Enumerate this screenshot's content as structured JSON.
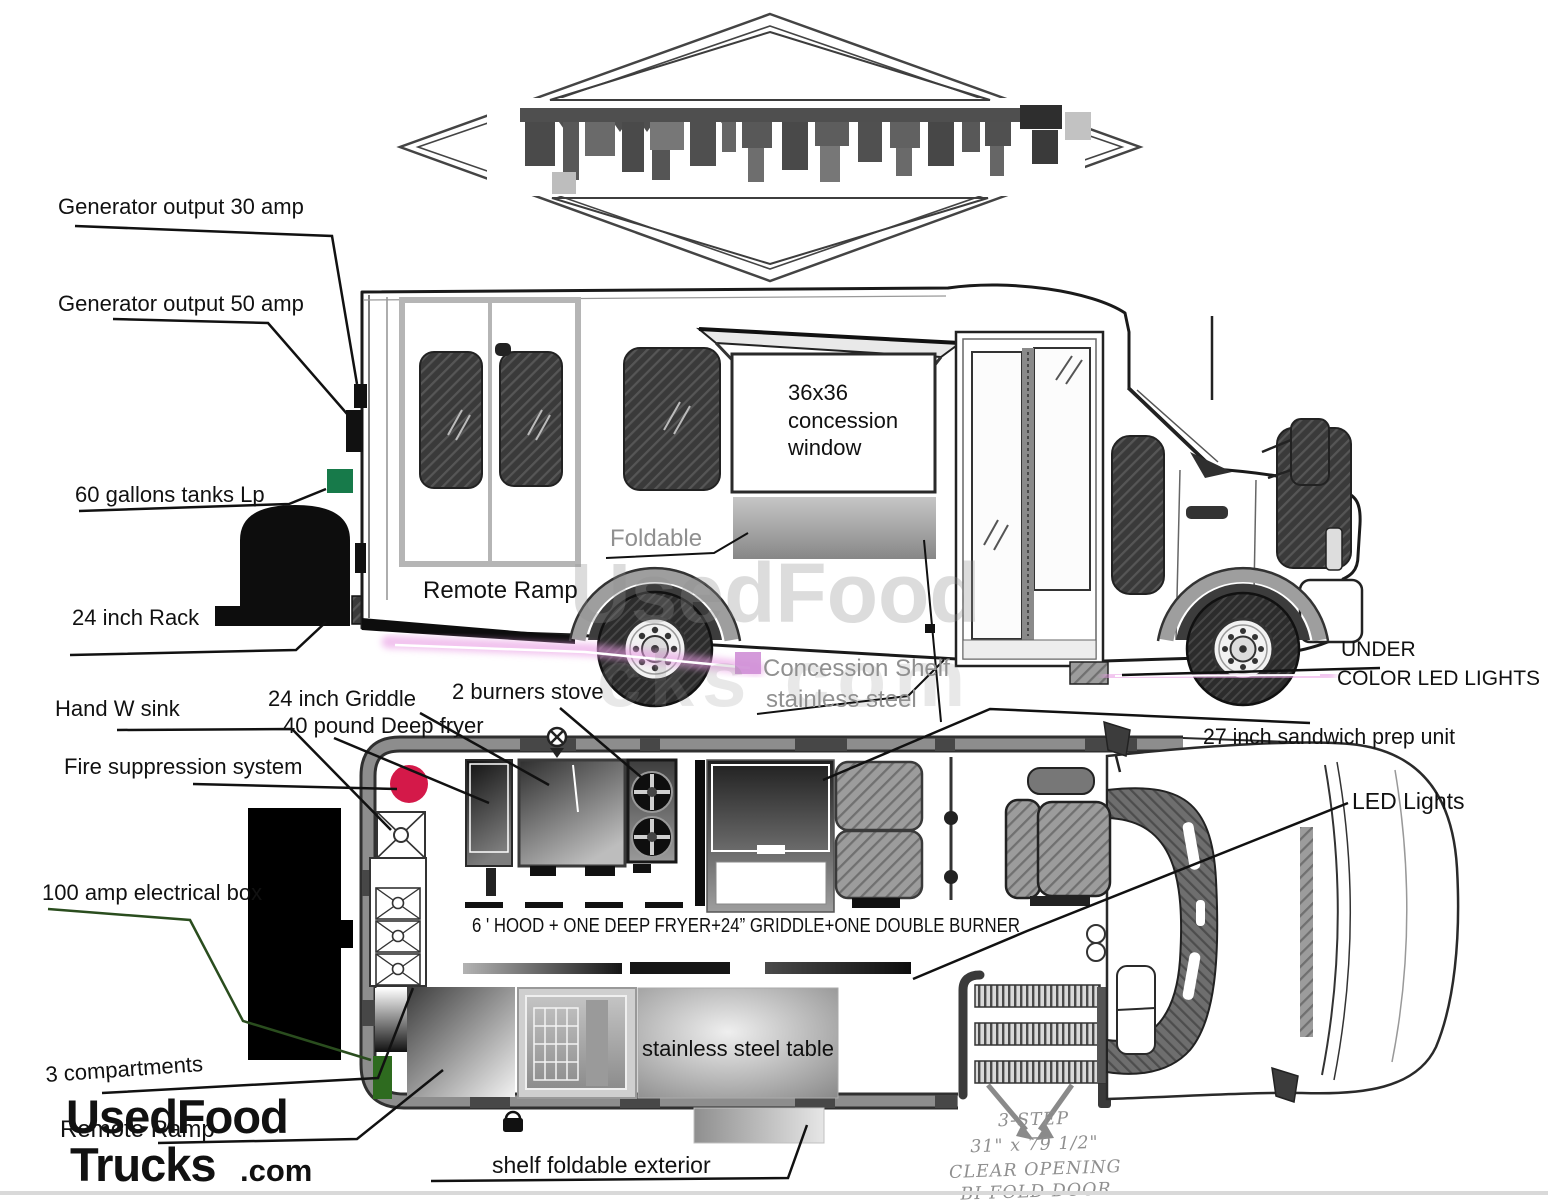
{
  "side_view": {
    "labels": {
      "generator_30": "Generator output 30 amp",
      "generator_50": "Generator output 50 amp",
      "lp_tanks": "60 gallons tanks Lp",
      "rack": "24 inch Rack",
      "remote_ramp": "Remote Ramp",
      "foldable": "Foldable",
      "window_1": "36x36",
      "window_2": "concession",
      "window_3": "window",
      "shelf_1": "Concession Shelf",
      "shelf_2": "stainless steel",
      "under_led_1": "UNDER",
      "under_led_2": "COLOR LED LIGHTS"
    }
  },
  "floor_plan": {
    "labels": {
      "hand_sink": "Hand W sink",
      "fire_suppression": "Fire suppression system",
      "electrical_box": "100 amp electrical box",
      "compartments": "3 compartments",
      "remote_ramp": "Remote Ramp",
      "griddle": "24 inch Griddle",
      "deep_fryer": "40 pound Deep fryer",
      "burners_stove": "2 burners stove",
      "sandwich_prep": "27 inch sandwich prep unit",
      "led_lights": "LED Lights",
      "hood_note": "6 ' HOOD + ONE DEEP FRYER+24” GRIDDLE+ONE DOUBLE BURNER",
      "steel_table": "stainless steel table",
      "shelf_exterior": "shelf foldable exterior",
      "steps_1": "3-STEP",
      "steps_2": "31\" x 79 1/2\"",
      "steps_3": "CLEAR OPENING",
      "steps_4": "BI-FOLD DOOR"
    }
  },
  "watermark": {
    "line1": "UsedFood",
    "line2": "cks com"
  },
  "logo": {
    "part1": "UsedFood",
    "part2": "Trucks",
    "suffix": ".com"
  },
  "colors": {
    "logo_red": "#e22b33",
    "fire_red": "#d41949",
    "lp_green": "#177a4a",
    "plan_green": "#2e6b1f",
    "elec_line_green": "#2a4d1e",
    "led_pink": "#e89ae3",
    "label_gray": "#909090"
  }
}
